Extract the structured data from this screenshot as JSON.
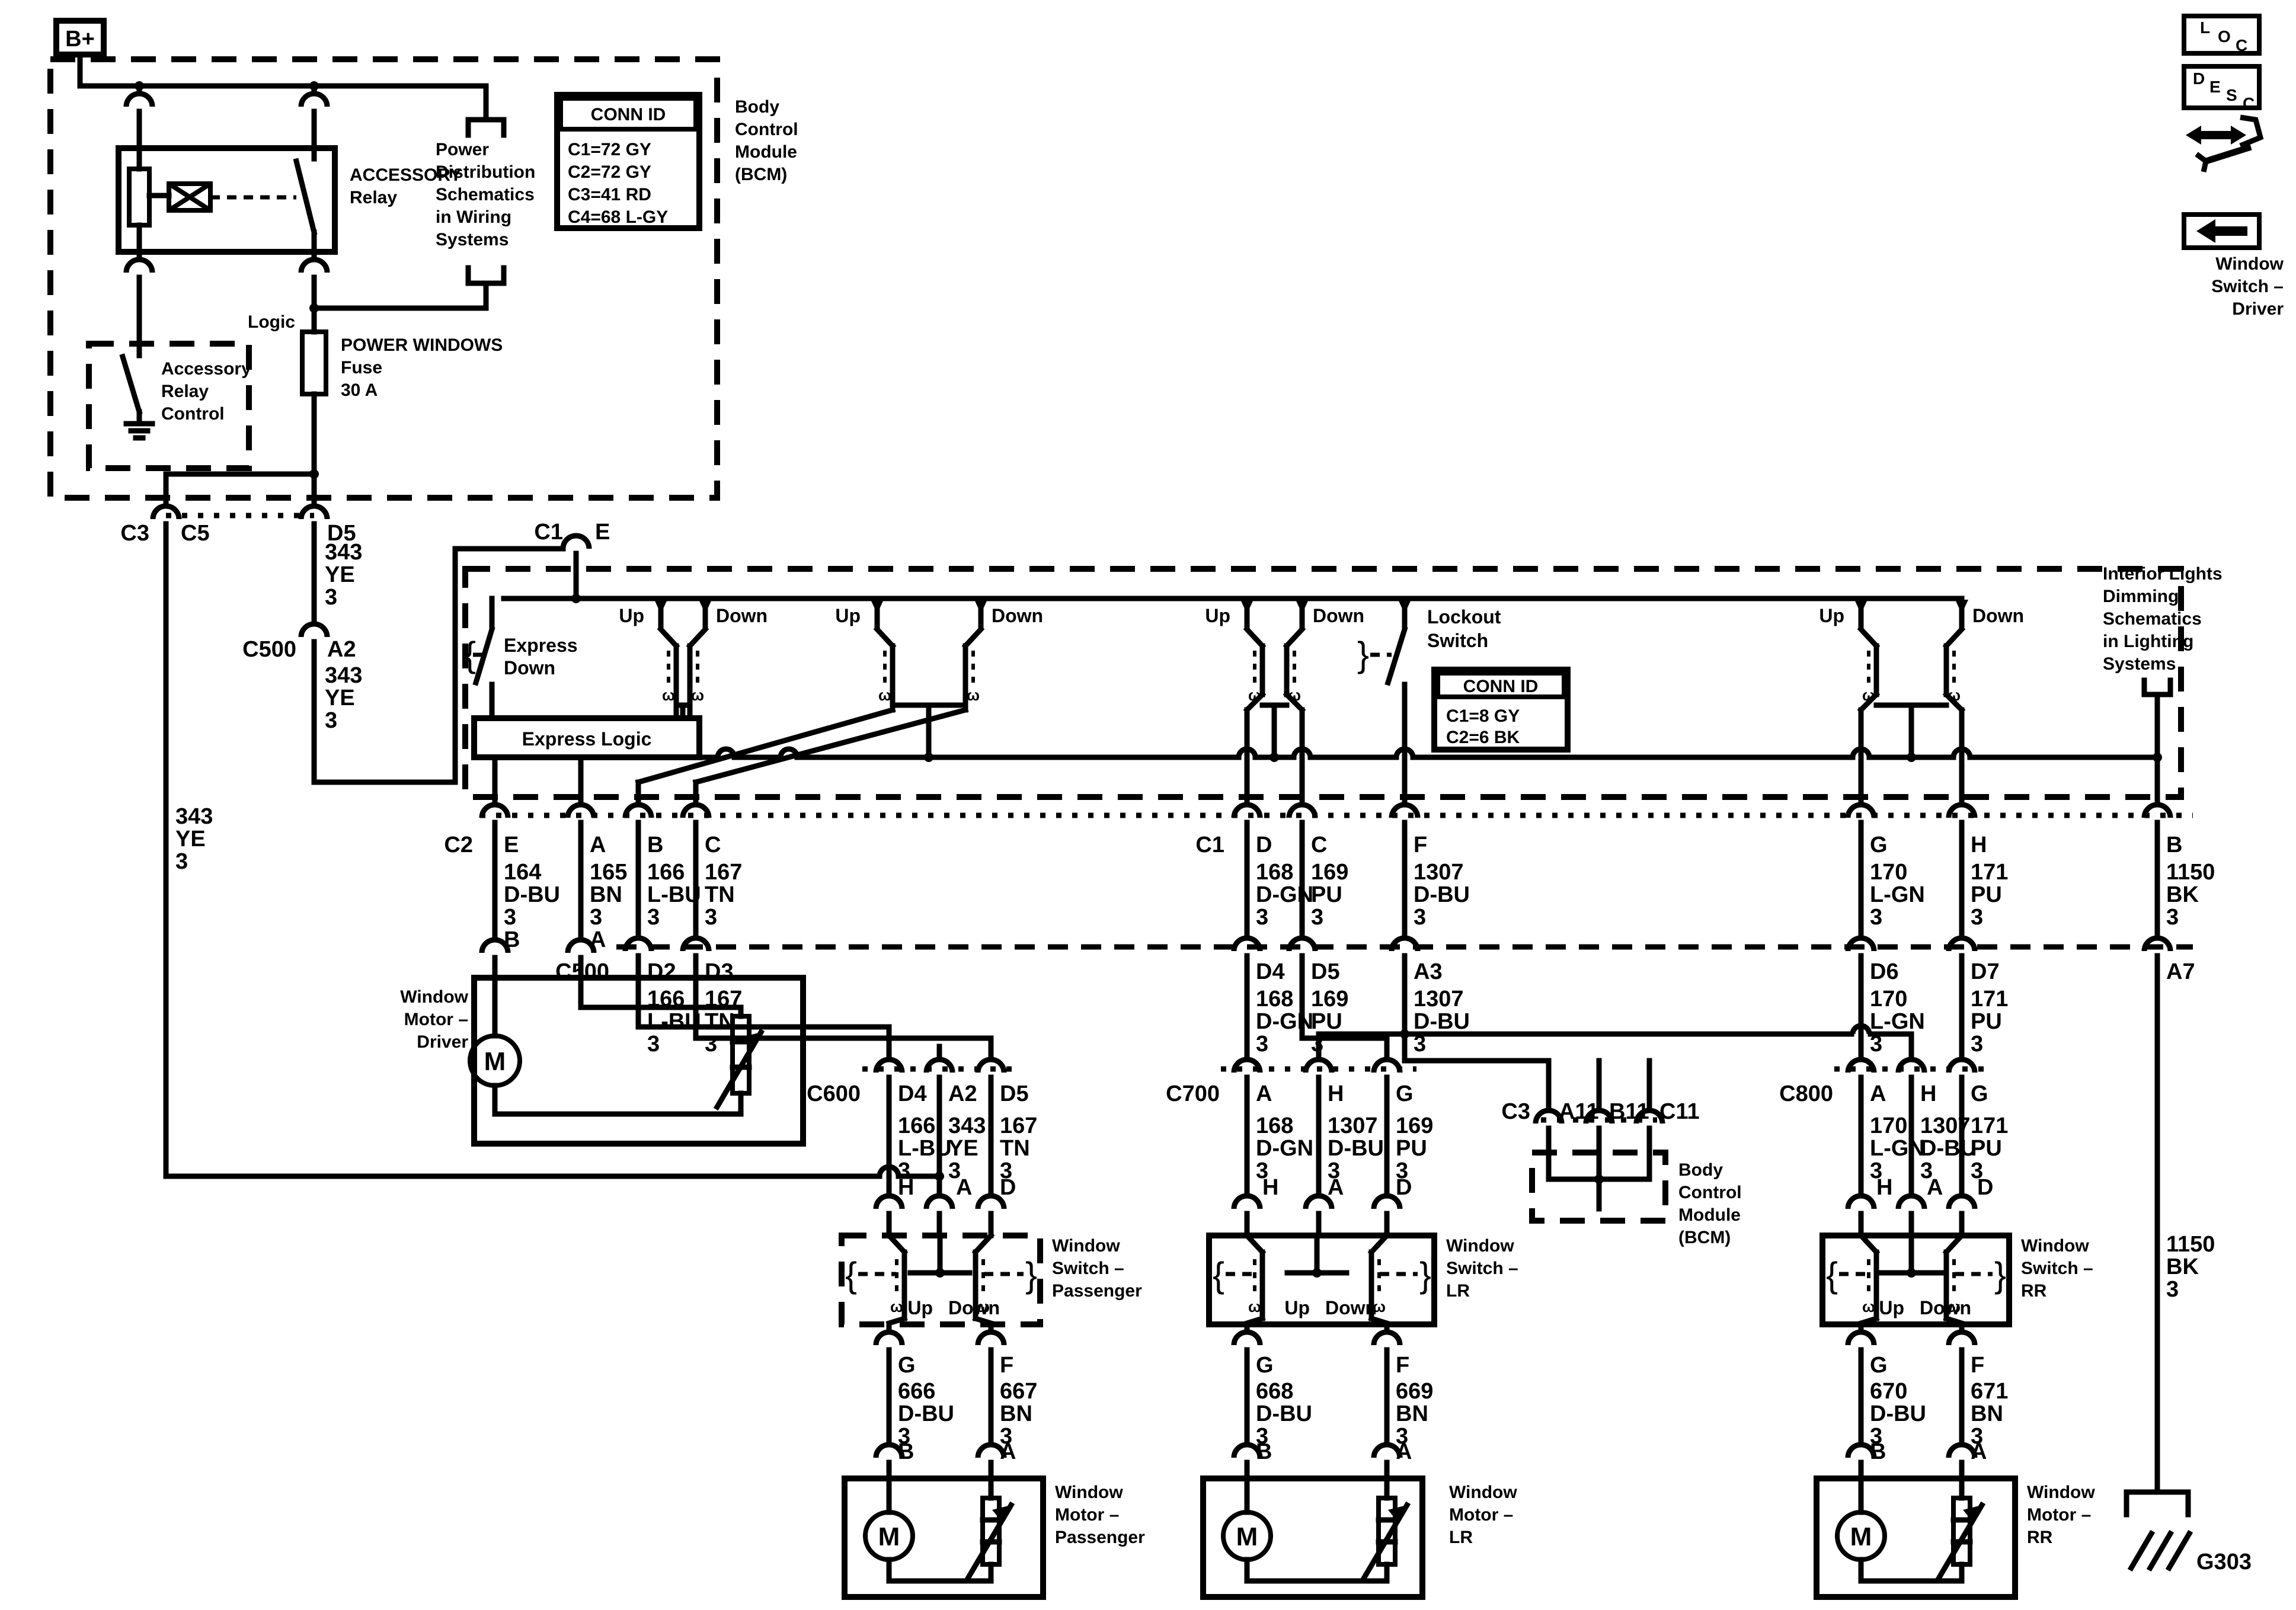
{
  "badges": {
    "b_plus": "B+",
    "loc": [
      "L",
      "O",
      "C"
    ],
    "desc": [
      "D",
      "E",
      "S",
      "C"
    ]
  },
  "corner": {
    "title": [
      "Window",
      "Switch –",
      "Driver"
    ]
  },
  "top_bcm": {
    "label": [
      "Body",
      "Control",
      "Module",
      "(BCM)"
    ],
    "conn_id": {
      "title": "CONN ID",
      "rows": [
        "C1=72 GY",
        "C2=72 GY",
        "C3=41 RD",
        "C4=68 L-GY"
      ]
    }
  },
  "relay": {
    "title": [
      "ACCESSORY",
      "Relay"
    ],
    "control": [
      "Accessory",
      "Relay",
      "Control"
    ]
  },
  "power_dist": {
    "lines": [
      "Power",
      "Distribution",
      "Schematics",
      "in Wiring",
      "Systems"
    ]
  },
  "fuse": {
    "lines": [
      "POWER WINDOWS",
      "Fuse",
      "30 A"
    ]
  },
  "logic": "Logic",
  "exit": {
    "conn": "C3",
    "pin_left": "C5",
    "pin_right": "D5"
  },
  "c500_left": {
    "conn": "C500",
    "pin": "A2"
  },
  "c1_entry": {
    "conn": "C1",
    "pin": "E"
  },
  "driver_switch": {
    "pairs": [
      {
        "up": "Up",
        "down": "Down"
      },
      {
        "up": "Up",
        "down": "Down"
      },
      {
        "up": "Up",
        "down": "Down"
      },
      {
        "up": "Up",
        "down": "Down"
      }
    ],
    "express": [
      "Express",
      "Down"
    ],
    "express_logic": "Express Logic",
    "lockout": [
      "Lockout",
      "Switch"
    ],
    "conn_id": {
      "title": "CONN ID",
      "rows": [
        "C1=8 GY",
        "C2=6 BK"
      ]
    },
    "interior": [
      "Interior Lights",
      "Dimming",
      "Schematics",
      "in Lighting",
      "Systems"
    ]
  },
  "row_a": {
    "conn_left": "C2",
    "conn_right": "C1",
    "pins": [
      "E",
      "A",
      "B",
      "C",
      "D",
      "C",
      "F",
      "G",
      "H",
      "B"
    ],
    "motor_pins": [
      "B",
      "A"
    ]
  },
  "row_b": {
    "conn": "C500",
    "pins": [
      "D2",
      "D3",
      "D4",
      "D5",
      "A3",
      "D6",
      "D7",
      "A7"
    ]
  },
  "row_c": {
    "conns": [
      "C600",
      "C700",
      "C800"
    ],
    "pins_600": [
      "D4",
      "A2",
      "D5"
    ],
    "pins_700": [
      "A",
      "H",
      "G"
    ],
    "pins_800": [
      "A",
      "H",
      "G"
    ]
  },
  "bcm_bottom": {
    "conn": "C3",
    "pins": [
      "A11",
      "B11",
      "C11"
    ],
    "label": [
      "Body",
      "Control",
      "Module",
      "(BCM)"
    ]
  },
  "switches": {
    "passenger": {
      "title": [
        "Window",
        "Switch –",
        "Passenger"
      ],
      "top_pins": [
        "H",
        "A",
        "D"
      ],
      "up": "Up",
      "down": "Down",
      "bottom_pins": [
        "G",
        "F"
      ],
      "motor_pins": [
        "B",
        "A"
      ]
    },
    "lr": {
      "title": [
        "Window",
        "Switch –",
        "LR"
      ],
      "top_pins": [
        "H",
        "A",
        "D"
      ],
      "up": "Up",
      "down": "Down",
      "bottom_pins": [
        "G",
        "F"
      ],
      "motor_pins": [
        "B",
        "A"
      ]
    },
    "rr": {
      "title": [
        "Window",
        "Switch –",
        "RR"
      ],
      "top_pins": [
        "H",
        "A",
        "D"
      ],
      "up": "Up",
      "down": "Down",
      "bottom_pins": [
        "G",
        "F"
      ],
      "motor_pins": [
        "B",
        "A"
      ]
    }
  },
  "motors": {
    "driver": [
      "Window",
      "Motor –",
      "Driver"
    ],
    "passenger": [
      "Window",
      "Motor –",
      "Passenger"
    ],
    "lr": [
      "Window",
      "Motor –",
      "LR"
    ],
    "rr": [
      "Window",
      "Motor –",
      "RR"
    ]
  },
  "ground": {
    "id": "G303"
  },
  "glyphs": {
    "motor": "M",
    "contact": "ω",
    "brace_l": "{",
    "brace_r": "}"
  },
  "stacks": {
    "left343": [
      "343",
      "YE",
      "3"
    ],
    "d5a": [
      "343",
      "YE",
      "3"
    ],
    "d5b": [
      "343",
      "YE",
      "3"
    ],
    "a164": [
      "164",
      "D-BU",
      "3"
    ],
    "a165": [
      "165",
      "BN",
      "3"
    ],
    "a166": [
      "166",
      "L-BU",
      "3"
    ],
    "a167": [
      "167",
      "TN",
      "3"
    ],
    "a168": [
      "168",
      "D-GN",
      "3"
    ],
    "a169": [
      "169",
      "PU",
      "3"
    ],
    "a1307": [
      "1307",
      "D-BU",
      "3"
    ],
    "a170": [
      "170",
      "L-GN",
      "3"
    ],
    "a171": [
      "171",
      "PU",
      "3"
    ],
    "a1150": [
      "1150",
      "BK",
      "3"
    ],
    "b166": [
      "166",
      "L-BU",
      "3"
    ],
    "b167": [
      "167",
      "TN",
      "3"
    ],
    "b168": [
      "168",
      "D-GN",
      "3"
    ],
    "b169": [
      "169",
      "PU",
      "3"
    ],
    "b1307": [
      "1307",
      "D-BU",
      "3"
    ],
    "b170": [
      "170",
      "L-GN",
      "3"
    ],
    "b171": [
      "171",
      "PU",
      "3"
    ],
    "c166": [
      "166",
      "L-BU",
      "3"
    ],
    "c343": [
      "343",
      "YE",
      "3"
    ],
    "c167": [
      "167",
      "TN",
      "3"
    ],
    "c168": [
      "168",
      "D-GN",
      "3"
    ],
    "c1307a": [
      "1307",
      "D-BU",
      "3"
    ],
    "c169": [
      "169",
      "PU",
      "3"
    ],
    "c170": [
      "170",
      "L-GN",
      "3"
    ],
    "c1307b": [
      "1307",
      "D-BU",
      "3"
    ],
    "c171": [
      "171",
      "PU",
      "3"
    ],
    "s666": [
      "666",
      "D-BU",
      "3"
    ],
    "s667": [
      "667",
      "BN",
      "3"
    ],
    "s668": [
      "668",
      "D-BU",
      "3"
    ],
    "s669": [
      "669",
      "BN",
      "3"
    ],
    "s670": [
      "670",
      "D-BU",
      "3"
    ],
    "s671": [
      "671",
      "BN",
      "3"
    ],
    "r1150b": [
      "1150",
      "BK",
      "3"
    ]
  }
}
